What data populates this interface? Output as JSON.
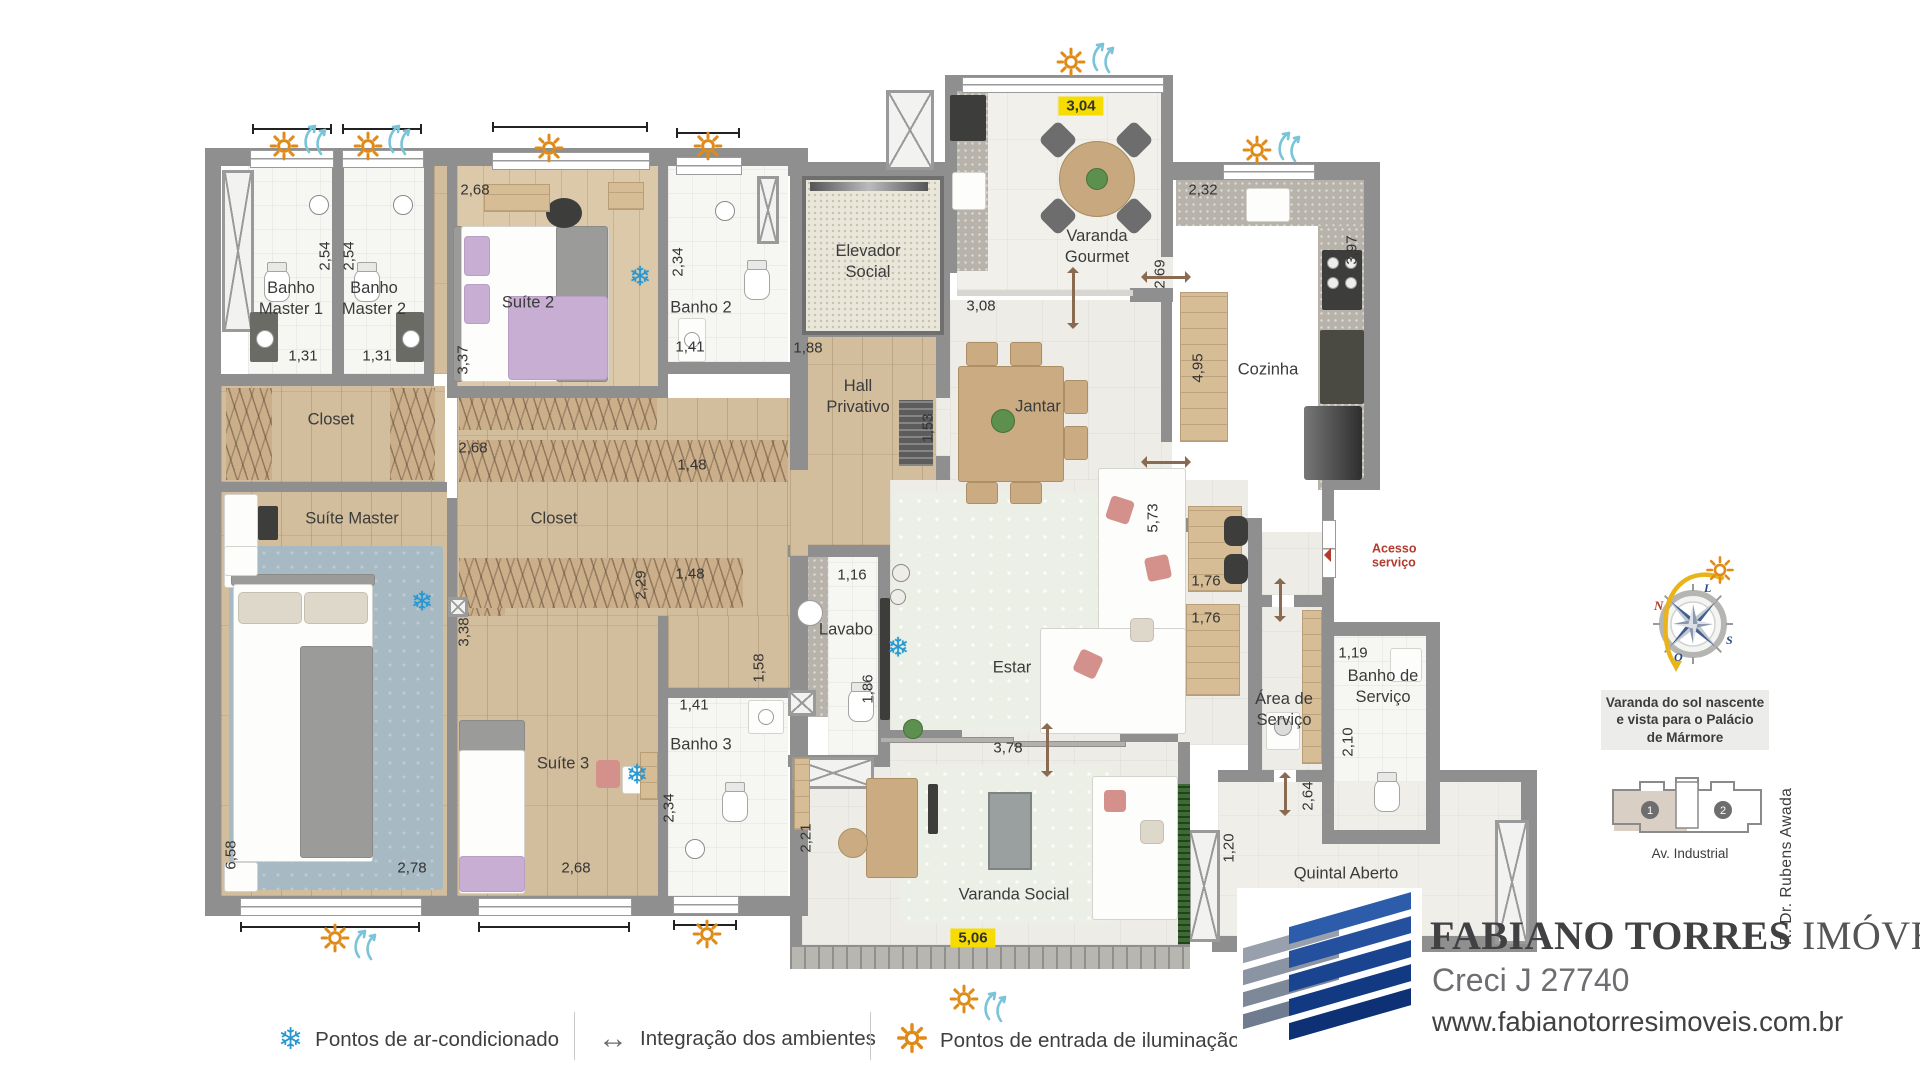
{
  "colors": {
    "wall": "#8f8f8f",
    "highlight_yellow": "#f6dc00",
    "accent_red": "#b23b2e",
    "sun_orange": "#e08b18",
    "wind_blue": "#79c4d9",
    "snow_blue": "#2697d0",
    "arrow_brown": "#8a6a50"
  },
  "rooms": [
    {
      "label": "Banho\nMaster 1",
      "x": 291,
      "y": 299
    },
    {
      "label": "Banho\nMaster 2",
      "x": 374,
      "y": 299
    },
    {
      "label": "Suíte 2",
      "x": 528,
      "y": 303
    },
    {
      "label": "Banho 2",
      "x": 701,
      "y": 308
    },
    {
      "label": "Elevador\nSocial",
      "x": 868,
      "y": 262
    },
    {
      "label": "Hall\nPrivativo",
      "x": 858,
      "y": 397
    },
    {
      "label": "Varanda\nGourmet",
      "x": 1097,
      "y": 247
    },
    {
      "label": "Cozinha",
      "x": 1268,
      "y": 370
    },
    {
      "label": "Jantar",
      "x": 1038,
      "y": 407
    },
    {
      "label": "Closet",
      "x": 331,
      "y": 420
    },
    {
      "label": "Suíte Master",
      "x": 352,
      "y": 519
    },
    {
      "label": "Closet",
      "x": 554,
      "y": 519
    },
    {
      "label": "Lavabo",
      "x": 846,
      "y": 630
    },
    {
      "label": "Estar",
      "x": 1012,
      "y": 668
    },
    {
      "label": "Área de\nServiço",
      "x": 1284,
      "y": 710
    },
    {
      "label": "Banho de\nServiço",
      "x": 1383,
      "y": 687
    },
    {
      "label": "Banho 3",
      "x": 701,
      "y": 745
    },
    {
      "label": "Suíte 3",
      "x": 563,
      "y": 764
    },
    {
      "label": "Varanda Social",
      "x": 1014,
      "y": 895
    },
    {
      "label": "Quintal Aberto",
      "x": 1346,
      "y": 874
    }
  ],
  "dimensions": [
    {
      "t": "2,54",
      "x": 325,
      "y": 256,
      "v": true
    },
    {
      "t": "2,54",
      "x": 349,
      "y": 256,
      "v": true
    },
    {
      "t": "1,31",
      "x": 303,
      "y": 356
    },
    {
      "t": "1,31",
      "x": 377,
      "y": 356
    },
    {
      "t": "2,68",
      "x": 475,
      "y": 190
    },
    {
      "t": "3,37",
      "x": 463,
      "y": 360,
      "v": true
    },
    {
      "t": "2,34",
      "x": 678,
      "y": 262,
      "v": true
    },
    {
      "t": "1,41",
      "x": 690,
      "y": 347
    },
    {
      "t": "1,88",
      "x": 808,
      "y": 348
    },
    {
      "t": "1,53",
      "x": 928,
      "y": 428,
      "v": true
    },
    {
      "t": "3,04",
      "x": 1081,
      "y": 106,
      "hl": true
    },
    {
      "t": "3,08",
      "x": 981,
      "y": 306
    },
    {
      "t": "2,69",
      "x": 1160,
      "y": 274,
      "v": true
    },
    {
      "t": "2,32",
      "x": 1203,
      "y": 190
    },
    {
      "t": "3,97",
      "x": 1352,
      "y": 250,
      "v": true
    },
    {
      "t": "4,95",
      "x": 1198,
      "y": 368,
      "v": true
    },
    {
      "t": "5,73",
      "x": 1153,
      "y": 518,
      "v": true
    },
    {
      "t": "1,76",
      "x": 1206,
      "y": 581
    },
    {
      "t": "1,76",
      "x": 1206,
      "y": 618
    },
    {
      "t": "1,16",
      "x": 852,
      "y": 575
    },
    {
      "t": "1,86",
      "x": 868,
      "y": 689,
      "v": true
    },
    {
      "t": "1,48",
      "x": 692,
      "y": 465
    },
    {
      "t": "1,48",
      "x": 690,
      "y": 574
    },
    {
      "t": "2,29",
      "x": 641,
      "y": 585,
      "v": true
    },
    {
      "t": "1,58",
      "x": 759,
      "y": 668,
      "v": true
    },
    {
      "t": "2,68",
      "x": 473,
      "y": 448
    },
    {
      "t": "3,38",
      "x": 464,
      "y": 632,
      "v": true
    },
    {
      "t": "1,41",
      "x": 694,
      "y": 705
    },
    {
      "t": "2,34",
      "x": 669,
      "y": 808,
      "v": true
    },
    {
      "t": "1,19",
      "x": 1353,
      "y": 653
    },
    {
      "t": "2,10",
      "x": 1348,
      "y": 742,
      "v": true
    },
    {
      "t": "2,64",
      "x": 1308,
      "y": 796,
      "v": true
    },
    {
      "t": "1,20",
      "x": 1229,
      "y": 848,
      "v": true
    },
    {
      "t": "2,21",
      "x": 806,
      "y": 838,
      "v": true
    },
    {
      "t": "3,78",
      "x": 1008,
      "y": 748
    },
    {
      "t": "5,06",
      "x": 973,
      "y": 938,
      "hl": true
    },
    {
      "t": "6,58",
      "x": 231,
      "y": 855,
      "v": true
    },
    {
      "t": "2,78",
      "x": 412,
      "y": 868
    },
    {
      "t": "2,68",
      "x": 576,
      "y": 868
    }
  ],
  "annotations": [
    {
      "label": "Acesso\nserviço",
      "x": 1372,
      "y": 556
    }
  ],
  "icons": {
    "suns": [
      [
        284,
        146
      ],
      [
        368,
        146
      ],
      [
        549,
        148
      ],
      [
        708,
        146
      ],
      [
        1071,
        62
      ],
      [
        1257,
        150
      ],
      [
        335,
        938
      ],
      [
        707,
        934
      ],
      [
        964,
        999
      ]
    ],
    "winds": [
      [
        314,
        139
      ],
      [
        398,
        139
      ],
      [
        1102,
        57
      ],
      [
        1288,
        146
      ],
      [
        364,
        944
      ],
      [
        994,
        1006
      ]
    ],
    "snowflakes": [
      [
        640,
        277
      ],
      [
        422,
        602
      ],
      [
        898,
        648
      ],
      [
        637,
        775
      ]
    ],
    "integration_arrows": [
      {
        "x": 1073,
        "y": 298,
        "dir": "v",
        "len": 56
      },
      {
        "x": 1166,
        "y": 277,
        "dir": "h",
        "len": 44
      },
      {
        "x": 1166,
        "y": 462,
        "dir": "h",
        "len": 44
      },
      {
        "x": 1280,
        "y": 600,
        "dir": "v",
        "len": 38
      },
      {
        "x": 1047,
        "y": 750,
        "dir": "v",
        "len": 48
      },
      {
        "x": 1285,
        "y": 794,
        "dir": "v",
        "len": 38
      }
    ]
  },
  "legend": {
    "items": [
      {
        "icon": "snowflake-icon",
        "label": "Pontos de ar-condicionado"
      },
      {
        "icon": "double-arrow-icon",
        "label": "Integração dos ambientes"
      },
      {
        "icon": "sun-icon",
        "label": "Pontos de entrada de iluminação e ve"
      }
    ]
  },
  "branding": {
    "company_bold": "FABIANO TORRES",
    "company_light": " IMÓVEIS",
    "creci": "Creci J 27740",
    "website": "www.fabianotorresimoveis.com.br"
  },
  "side_panel": {
    "compass": {
      "n": "N",
      "l": "L",
      "s": "S",
      "o": "O"
    },
    "note": "Varanda do sol nascente\ne vista para o Palácio\nde Mármore",
    "keyplan": {
      "unit1": "1",
      "unit2": "2",
      "street_bottom": "Av. Industrial",
      "street_right": "R. Dr. Rubens Awada"
    }
  }
}
